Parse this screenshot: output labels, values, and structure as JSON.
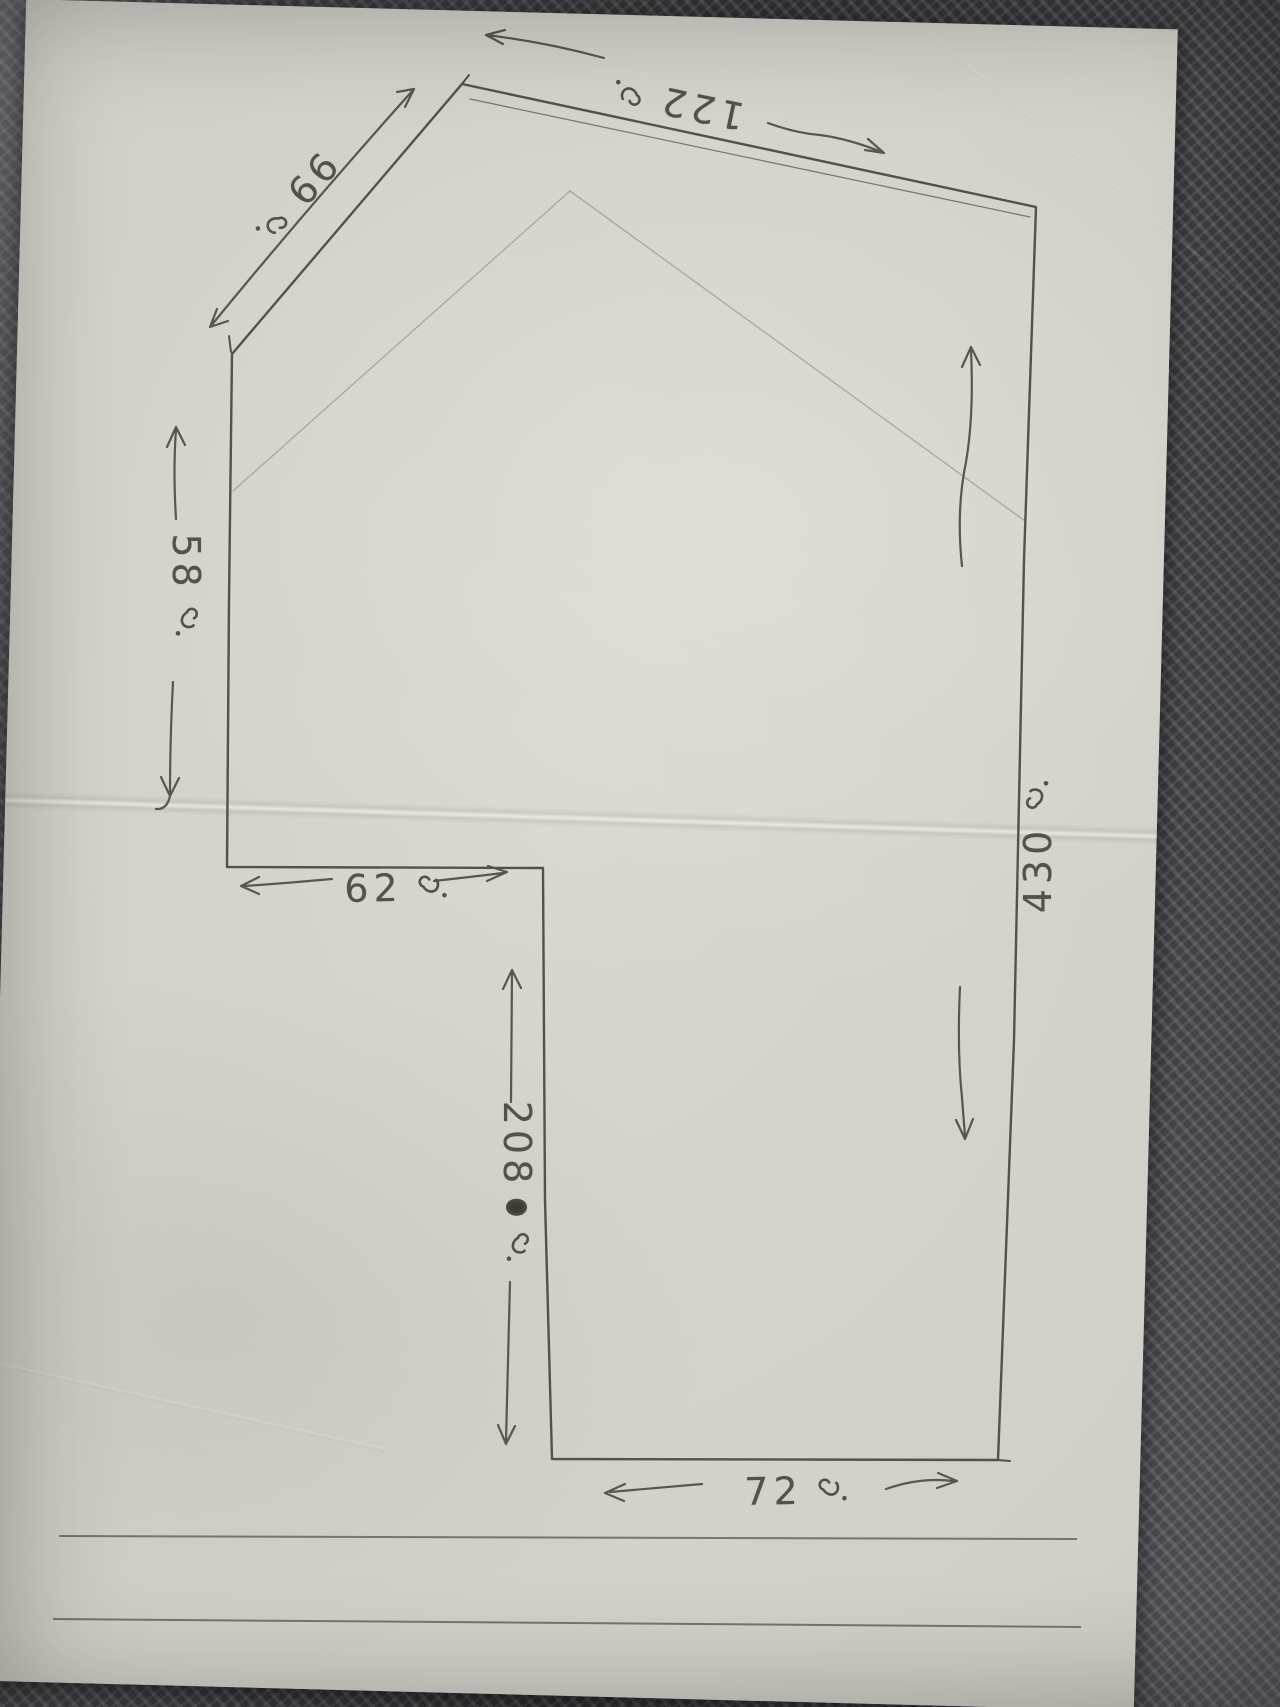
{
  "figure": {
    "kind": "hand-drawn land plot sketch in pencil",
    "unit_symbol": "ว.",
    "colors": {
      "paper": "#d2cfc8",
      "pencil": "#55514a",
      "mat": "#3a3a3e"
    }
  },
  "labels": {
    "diagonal": {
      "value": "99",
      "unit": "ว.",
      "side": "upper-left diagonal edge"
    },
    "top": {
      "value": "122",
      "unit": "ว.",
      "side": "top edge"
    },
    "left": {
      "value": "58",
      "unit": "ว.",
      "side": "left edge"
    },
    "notch": {
      "value": "62",
      "unit": "ว.",
      "side": "inner notch horizontal edge"
    },
    "inner": {
      "value": "208",
      "unit": "ว.",
      "side": "inner vertical edge",
      "has_scribbled_out_digit": true
    },
    "right": {
      "value": "430",
      "unit": "ว.",
      "side": "right edge"
    },
    "bottom": {
      "value": "72",
      "unit": "ว.",
      "side": "bottom edge"
    }
  }
}
